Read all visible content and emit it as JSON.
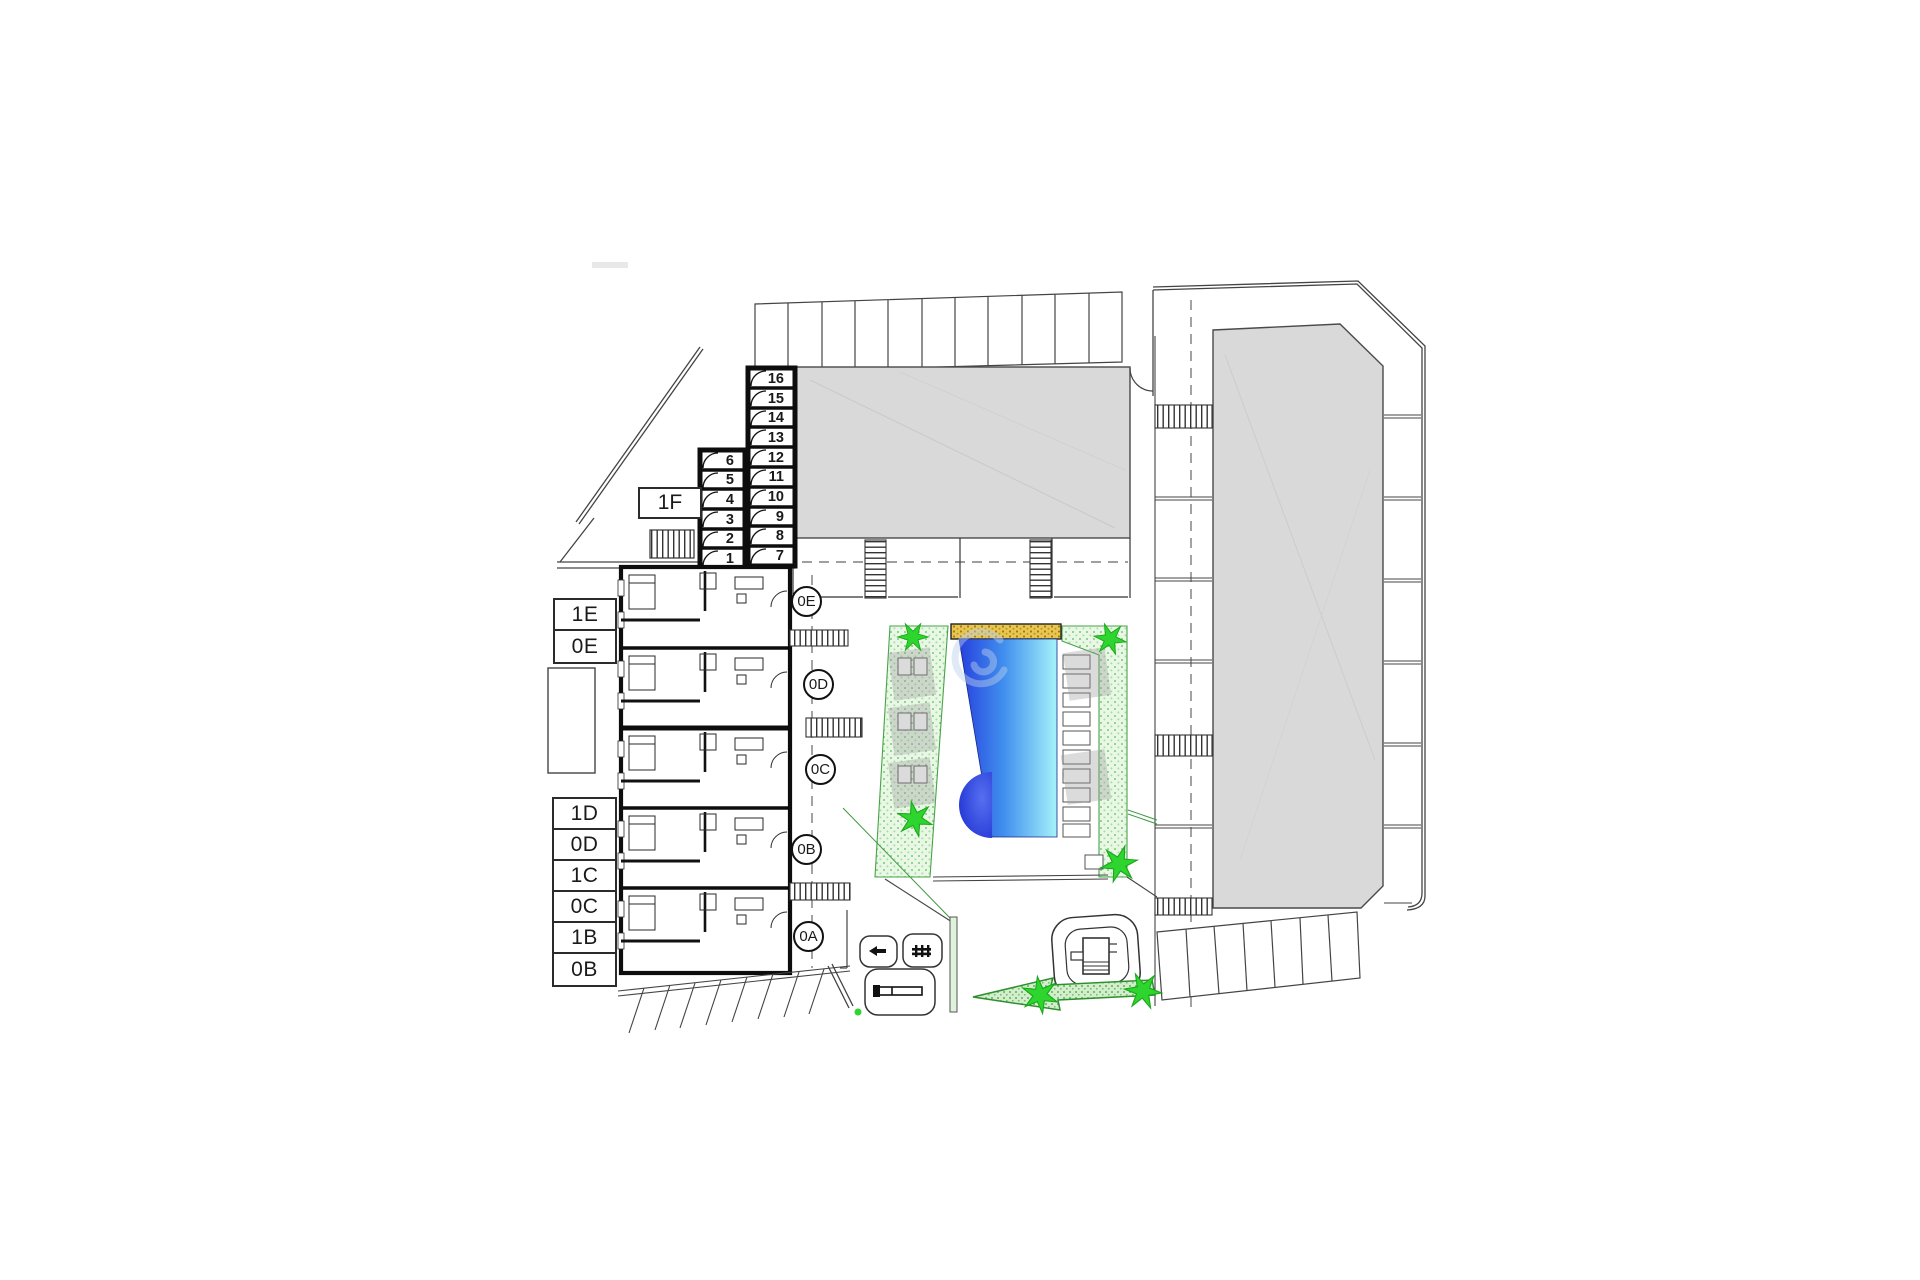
{
  "garage": {
    "right_column_numbers": [
      "16",
      "15",
      "14",
      "13",
      "12",
      "11",
      "10",
      "9",
      "8",
      "7"
    ],
    "left_column_numbers": [
      "6",
      "5",
      "4",
      "3",
      "2",
      "1"
    ]
  },
  "unit_labels": {
    "block_f": "1F",
    "upper_stack": [
      "1E",
      "0E"
    ],
    "lower_stack": [
      "1D",
      "0D",
      "1C",
      "0C",
      "1B",
      "0B"
    ]
  },
  "entrance_circles": [
    "0E",
    "0D",
    "0C",
    "0B",
    "0A"
  ],
  "colors": {
    "building_fill": "#d9d9d9",
    "wall": "#111111",
    "line": "#444444",
    "pool_gradient_left": "#2740de",
    "pool_gradient_mid": "#3f8eee",
    "pool_gradient_right": "#a5f2fb",
    "pool_bulge": "#1b2bd0",
    "pergola_strip": "#e9c74f",
    "lawn_fill": "#e9f7e5",
    "lawn_dot": "#7cc97c",
    "tree_star": "#2ed52e",
    "watermark": "#bcd0ec"
  },
  "icons": {
    "tree_icon": "six-point green star",
    "stairs_icon": "hatched ladder strip",
    "swimming_pool_icon": "blue gradient basin with round step",
    "pergola_icon": "gold dotted strip",
    "sun_lounger_icon": "small paired rectangles",
    "direction_arrow_icon": "dotted green arrow pointing left",
    "playground_icon": "rounded enclosure with play equipment",
    "bench_icon": "small glyph in rounded square",
    "bike_rack_icon": "long bar in rounded square",
    "door_swing_icon": "quarter-circle arc"
  }
}
